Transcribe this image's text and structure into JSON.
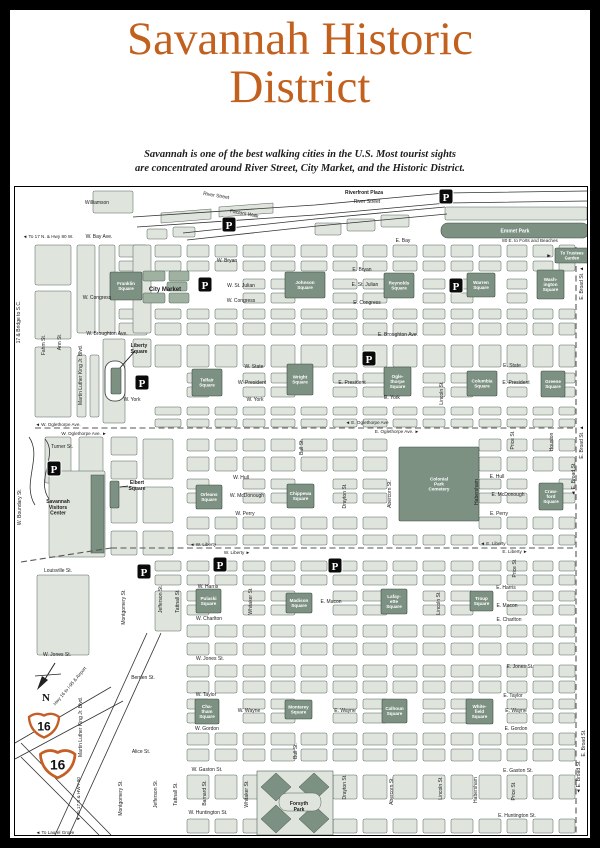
{
  "title": {
    "line1": "Savannah Historic",
    "line2": "District"
  },
  "subtitle": {
    "line1": "Savannah is one of the best walking cities in the U.S. Most tourist sights",
    "line2": "are concentrated around River Street, City Market, and the Historic District."
  },
  "colors": {
    "title_orange": "#c2601e",
    "shield_orange": "#c55f26",
    "square_green": "#7d9183",
    "block_green": "#dfe4dd",
    "mid_green": "#9fb2a1",
    "ink": "#1c1c1c"
  },
  "map": {
    "squares": [
      {
        "n": "emmet-park",
        "l": "Emmet Park",
        "x": 426,
        "y": 36,
        "w": 148,
        "h": 15,
        "r": 7,
        "fs": 5,
        "single": 1
      },
      {
        "n": "trustees-garden-sign",
        "l": "To Trustees\nGarden",
        "x": 540,
        "y": 61,
        "w": 34,
        "h": 15,
        "fs": 4.2
      },
      {
        "n": "franklin-square",
        "l": "Franklin\nSquare",
        "x": 95,
        "y": 85,
        "w": 32,
        "h": 28
      },
      {
        "n": "johnson-square",
        "l": "Johnson\nSquare",
        "x": 270,
        "y": 85,
        "w": 40,
        "h": 26
      },
      {
        "n": "reynolds-square",
        "l": "Reynolds\nSquare",
        "x": 369,
        "y": 86,
        "w": 30,
        "h": 25
      },
      {
        "n": "warren-square",
        "l": "Warren\nSquare",
        "x": 452,
        "y": 86,
        "w": 28,
        "h": 24
      },
      {
        "n": "washington-square",
        "l": "Wash-\nington\nSquare",
        "x": 522,
        "y": 83,
        "w": 27,
        "h": 29
      },
      {
        "n": "liberty-square-strip",
        "l": "",
        "x": 96,
        "y": 181,
        "w": 10,
        "h": 26
      },
      {
        "n": "telfair-square",
        "l": "Telfair\nSquare",
        "x": 177,
        "y": 182,
        "w": 30,
        "h": 27
      },
      {
        "n": "wright-square",
        "l": "Wright\nSquare",
        "x": 272,
        "y": 177,
        "w": 26,
        "h": 31
      },
      {
        "n": "oglethorpe-square",
        "l": "Ogle-\nthorpe\nSquare",
        "x": 369,
        "y": 180,
        "w": 27,
        "h": 29
      },
      {
        "n": "columbia-square",
        "l": "Columbia\nSquare",
        "x": 452,
        "y": 184,
        "w": 30,
        "h": 25
      },
      {
        "n": "greene-square",
        "l": "Greene\nSquare",
        "x": 526,
        "y": 184,
        "w": 24,
        "h": 26
      },
      {
        "n": "colonial-park-cemetery",
        "l": "Colonial\nPark\nCemetery",
        "x": 384,
        "y": 260,
        "w": 80,
        "h": 74
      },
      {
        "n": "crawford-square",
        "l": "Craw-\nford\nSquare",
        "x": 524,
        "y": 296,
        "w": 24,
        "h": 27
      },
      {
        "n": "elbert-square-strip",
        "l": "",
        "x": 95,
        "y": 294,
        "w": 9,
        "h": 27
      },
      {
        "n": "orleans-square",
        "l": "Orleans\nSquare",
        "x": 181,
        "y": 298,
        "w": 26,
        "h": 24
      },
      {
        "n": "chippewa-square",
        "l": "Chippewa\nSquare",
        "x": 272,
        "y": 297,
        "w": 27,
        "h": 24
      },
      {
        "n": "pulaski-square",
        "l": "Pulaski\nSquare",
        "x": 181,
        "y": 402,
        "w": 25,
        "h": 24
      },
      {
        "n": "madison-square",
        "l": "Madison\nSquare",
        "x": 271,
        "y": 406,
        "w": 26,
        "h": 20
      },
      {
        "n": "lafayette-square",
        "l": "Lafay-\nette\nSquare",
        "x": 366,
        "y": 402,
        "w": 26,
        "h": 25
      },
      {
        "n": "troup-square",
        "l": "Troup\nSquare",
        "x": 455,
        "y": 404,
        "w": 23,
        "h": 20
      },
      {
        "n": "chatham-square",
        "l": "Cha-\ntham\nSquare",
        "x": 180,
        "y": 512,
        "w": 24,
        "h": 25
      },
      {
        "n": "monterey-square",
        "l": "Monterey\nSquare",
        "x": 270,
        "y": 513,
        "w": 27,
        "h": 19
      },
      {
        "n": "calhoun-square",
        "l": "Calhoun\nSquare",
        "x": 367,
        "y": 512,
        "w": 25,
        "h": 24
      },
      {
        "n": "whitefield-square",
        "l": "White-\nfield\nSquare",
        "x": 451,
        "y": 512,
        "w": 27,
        "h": 25
      }
    ],
    "labels": [
      {
        "t": "Riverfront Plaza",
        "x": 349,
        "y": 7,
        "b": 1
      },
      {
        "t": "River Street",
        "x": 352,
        "y": 16
      },
      {
        "t": "River Street",
        "x": 201,
        "y": 10,
        "r": 9
      },
      {
        "t": "Factors Walk",
        "x": 229,
        "y": 28,
        "r": 11
      },
      {
        "t": "Williamson",
        "x": 82,
        "y": 17
      },
      {
        "t": "◄ To 17 N. & Hwy 80 W.",
        "x": 33,
        "y": 51,
        "s": 4.6
      },
      {
        "t": "W. Bay Ave.",
        "x": 84,
        "y": 51
      },
      {
        "t": "E. Bay",
        "x": 388,
        "y": 55
      },
      {
        "t": "80 E. to Forts and Beaches",
        "x": 515,
        "y": 55,
        "s": 4.6
      },
      {
        "t": "▶",
        "x": 534,
        "y": 70,
        "s": 4.6
      },
      {
        "t": "W. Bryan",
        "x": 212,
        "y": 75
      },
      {
        "t": "E. Bryan",
        "x": 347,
        "y": 84
      },
      {
        "t": "City Market",
        "x": 150,
        "y": 104,
        "b": 1,
        "s": 6
      },
      {
        "t": "W. St. Julian",
        "x": 226,
        "y": 100
      },
      {
        "t": "E. St. Julian",
        "x": 350,
        "y": 99
      },
      {
        "t": "W. Congress",
        "x": 82,
        "y": 112
      },
      {
        "t": "W. Congress",
        "x": 226,
        "y": 115
      },
      {
        "t": "E. Congress",
        "x": 352,
        "y": 117
      },
      {
        "t": "W. Broughton Ave.",
        "x": 92,
        "y": 148
      },
      {
        "t": "E. Broughton Ave.",
        "x": 383,
        "y": 149
      },
      {
        "t": "17 & Bridge to S.C.",
        "x": 5,
        "y": 135,
        "r": -90
      },
      {
        "t": "Fahm St.",
        "x": 30,
        "y": 158,
        "r": -90
      },
      {
        "t": "Ann St.",
        "x": 46,
        "y": 155,
        "r": -90
      },
      {
        "t": "Martin Luther King Jr. Blvd.",
        "x": 67,
        "y": 188,
        "r": -90
      },
      {
        "t": "E. Broad St. ▲",
        "x": 568,
        "y": 96,
        "r": -90
      },
      {
        "t": "Liberty\nSquare",
        "x": 124,
        "y": 160,
        "b": 1
      },
      {
        "t": "W. State",
        "x": 239,
        "y": 181
      },
      {
        "t": "E. State",
        "x": 497,
        "y": 180
      },
      {
        "t": "W. President",
        "x": 237,
        "y": 197
      },
      {
        "t": "E. President",
        "x": 337,
        "y": 197
      },
      {
        "t": "E. President",
        "x": 501,
        "y": 197
      },
      {
        "t": "W. York",
        "x": 117,
        "y": 214
      },
      {
        "t": "W. York",
        "x": 240,
        "y": 214
      },
      {
        "t": "E. York",
        "x": 377,
        "y": 212
      },
      {
        "t": "Bull St.",
        "x": 288,
        "y": 260,
        "r": -90
      },
      {
        "t": "Lincoln St.",
        "x": 428,
        "y": 206,
        "r": -90
      },
      {
        "t": "◄ W. Oglethorpe Ave.",
        "x": 43,
        "y": 239,
        "s": 4.6
      },
      {
        "t": "W. Oglethorpe Ave. ►",
        "x": 69,
        "y": 248,
        "s": 4.6
      },
      {
        "t": "◄ E. Oglethorpe Ave",
        "x": 352,
        "y": 237,
        "s": 4.6
      },
      {
        "t": "E. Oglethorpe Ave. ►",
        "x": 382,
        "y": 246,
        "s": 4.6
      },
      {
        "t": "Turner St.",
        "x": 47,
        "y": 261
      },
      {
        "t": "Houston",
        "x": 538,
        "y": 255,
        "r": -90
      },
      {
        "t": "E. Broad St. ▲",
        "x": 568,
        "y": 255,
        "r": -90
      },
      {
        "t": "◄ E. Broad St.",
        "x": 560,
        "y": 292,
        "r": -90
      },
      {
        "t": "Price St.",
        "x": 499,
        "y": 253,
        "r": -90
      },
      {
        "t": "W. Hull",
        "x": 226,
        "y": 292
      },
      {
        "t": "E. Hull",
        "x": 482,
        "y": 291
      },
      {
        "t": "W. McDonough",
        "x": 232,
        "y": 310
      },
      {
        "t": "E. McDonough",
        "x": 493,
        "y": 309
      },
      {
        "t": "W. Perry",
        "x": 230,
        "y": 328
      },
      {
        "t": "E. Perry",
        "x": 484,
        "y": 328
      },
      {
        "t": "Elbert\nSquare",
        "x": 122,
        "y": 297,
        "b": 1
      },
      {
        "t": "Savannah\nVisitors\nCenter",
        "x": 43,
        "y": 316,
        "b": 1
      },
      {
        "t": "W. Boundary St.",
        "x": 6,
        "y": 320,
        "r": -90
      },
      {
        "t": "Drayton St.",
        "x": 331,
        "y": 309,
        "r": -90
      },
      {
        "t": "Abercorn St.",
        "x": 376,
        "y": 307,
        "r": -90
      },
      {
        "t": "Habersham",
        "x": 463,
        "y": 305,
        "r": -90
      },
      {
        "t": "◄ W. Liberty",
        "x": 188,
        "y": 359,
        "s": 4.6
      },
      {
        "t": "W. Liberty ►",
        "x": 222,
        "y": 367,
        "s": 4.6
      },
      {
        "t": "◄ E. Liberty",
        "x": 478,
        "y": 358,
        "s": 4.6
      },
      {
        "t": "E. Liberty ►",
        "x": 500,
        "y": 366,
        "s": 4.6
      },
      {
        "t": "Louisville St.",
        "x": 43,
        "y": 385
      },
      {
        "t": "W. Harris",
        "x": 193,
        "y": 401
      },
      {
        "t": "E. Harris",
        "x": 491,
        "y": 402
      },
      {
        "t": "E. Macon",
        "x": 316,
        "y": 416
      },
      {
        "t": "E. Macon",
        "x": 492,
        "y": 420
      },
      {
        "t": "W. Charlton",
        "x": 194,
        "y": 433
      },
      {
        "t": "E. Charlton",
        "x": 494,
        "y": 434
      },
      {
        "t": "Montgomery St.",
        "x": 110,
        "y": 420,
        "r": -90
      },
      {
        "t": "Jefferson St.",
        "x": 147,
        "y": 412,
        "r": -90
      },
      {
        "t": "Tattnall St.",
        "x": 164,
        "y": 414,
        "r": -90
      },
      {
        "t": "Whitaker St.",
        "x": 237,
        "y": 414,
        "r": -90
      },
      {
        "t": "Lincoln St.",
        "x": 425,
        "y": 416,
        "r": -90
      },
      {
        "t": "Price St.",
        "x": 501,
        "y": 381,
        "r": -90
      },
      {
        "t": "W. Jones St.",
        "x": 42,
        "y": 469
      },
      {
        "t": "W. Jones St.",
        "x": 195,
        "y": 473
      },
      {
        "t": "E. Jones St.",
        "x": 505,
        "y": 481
      },
      {
        "t": "Berrien St.",
        "x": 128,
        "y": 492
      },
      {
        "t": "W. Taylor",
        "x": 191,
        "y": 509
      },
      {
        "t": "E. Taylor",
        "x": 498,
        "y": 510
      },
      {
        "t": "W. Wayne",
        "x": 234,
        "y": 525
      },
      {
        "t": "E. Wayne",
        "x": 330,
        "y": 525
      },
      {
        "t": "E. Wayne",
        "x": 501,
        "y": 525
      },
      {
        "t": "W. Gordon",
        "x": 192,
        "y": 543
      },
      {
        "t": "E. Gordon",
        "x": 501,
        "y": 543
      },
      {
        "t": "Alice St.",
        "x": 126,
        "y": 566
      },
      {
        "t": "W. Gaston St.",
        "x": 192,
        "y": 584
      },
      {
        "t": "E. Gaston St.",
        "x": 503,
        "y": 585
      },
      {
        "t": "W. Huntington St.",
        "x": 193,
        "y": 627
      },
      {
        "t": "E. Huntington St.",
        "x": 502,
        "y": 630
      },
      {
        "t": "◄ To Laurel Grove",
        "x": 40,
        "y": 647,
        "s": 4.6
      },
      {
        "t": "▼ To 17 S & HWY 80",
        "x": 65,
        "y": 612,
        "r": -90,
        "s": 4.6
      },
      {
        "t": "East",
        "x": 44,
        "y": 581
      },
      {
        "t": "Hwy 16 to I-95 & Airport",
        "x": 56,
        "y": 500,
        "r": -50,
        "s": 4.6
      },
      {
        "t": "Martin Luther King Jr. Blvd.",
        "x": 67,
        "y": 540,
        "r": -90
      },
      {
        "t": "Montgomery St.",
        "x": 107,
        "y": 611,
        "r": -90
      },
      {
        "t": "Jefferson St.",
        "x": 142,
        "y": 607,
        "r": -90
      },
      {
        "t": "Tattnall St.",
        "x": 162,
        "y": 607,
        "r": -90
      },
      {
        "t": "Barnard St.",
        "x": 191,
        "y": 606,
        "r": -90
      },
      {
        "t": "Whitaker St.",
        "x": 233,
        "y": 607,
        "r": -90
      },
      {
        "t": "Bull St.",
        "x": 282,
        "y": 564,
        "r": -90
      },
      {
        "t": "Drayton St.",
        "x": 331,
        "y": 600,
        "r": -90
      },
      {
        "t": "Abercorn St.",
        "x": 378,
        "y": 604,
        "r": -90
      },
      {
        "t": "Lincoln St.",
        "x": 427,
        "y": 601,
        "r": -90
      },
      {
        "t": "Habersham",
        "x": 462,
        "y": 603,
        "r": -90
      },
      {
        "t": "Price St.",
        "x": 500,
        "y": 604,
        "r": -90
      },
      {
        "t": "◄ E. Broad St.",
        "x": 565,
        "y": 590,
        "r": -90
      },
      {
        "t": "E. Broad St.",
        "x": 570,
        "y": 556,
        "r": -90
      },
      {
        "t": "Forsyth\nPark",
        "x": 284,
        "y": 618,
        "b": 1
      }
    ],
    "parking": [
      {
        "x": 207,
        "y": 30
      },
      {
        "x": 424,
        "y": 2
      },
      {
        "x": 183,
        "y": 90
      },
      {
        "x": 434,
        "y": 91
      },
      {
        "x": 347,
        "y": 164
      },
      {
        "x": 120,
        "y": 188
      },
      {
        "x": 32,
        "y": 274
      },
      {
        "x": 122,
        "y": 377
      },
      {
        "x": 198,
        "y": 370
      },
      {
        "x": 313,
        "y": 371
      }
    ],
    "shields": [
      {
        "text": "16",
        "x": 11,
        "y": 522,
        "scale": 1
      },
      {
        "text": "16",
        "x": 22,
        "y": 558,
        "scale": 1.15
      }
    ],
    "compass": {
      "label": "N"
    }
  }
}
